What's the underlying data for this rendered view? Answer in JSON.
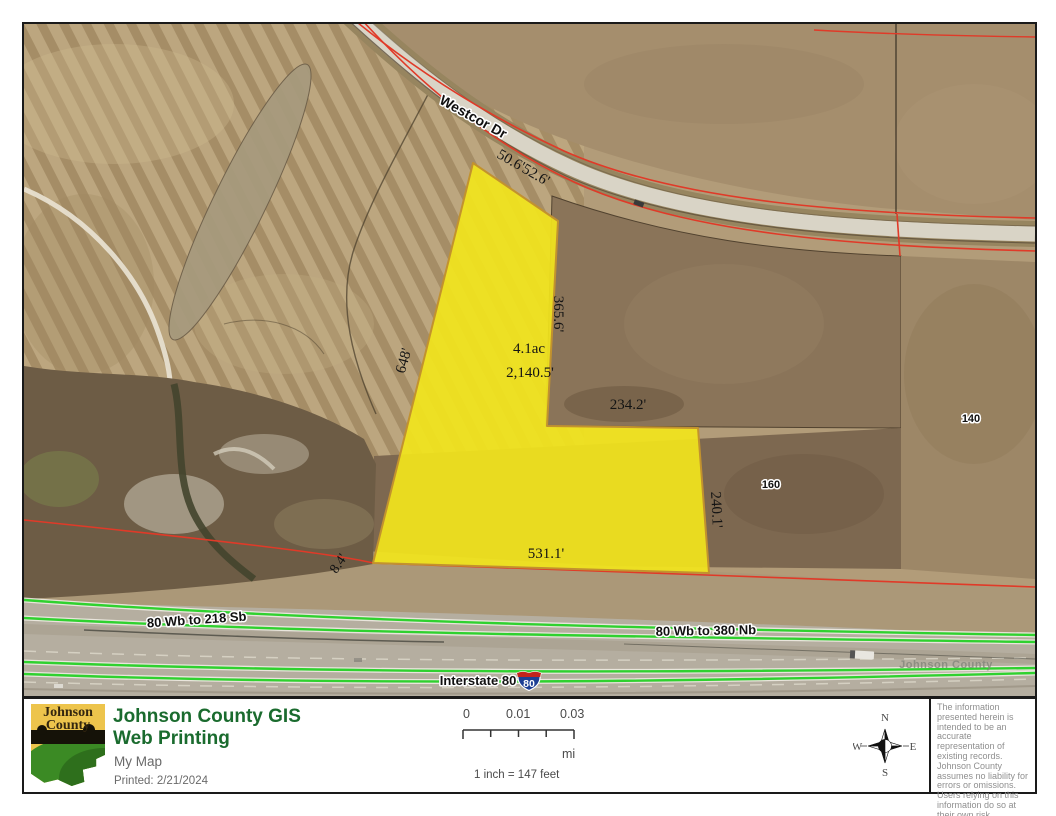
{
  "map": {
    "road_label": "Westcor Dr",
    "measurements": {
      "road_a": "50.6'",
      "road_b": "52.6'",
      "east_upper": "365.6'",
      "area": "4.1ac",
      "perimeter": "2,140.5'",
      "north_inner": "234.2'",
      "west": "648'",
      "east_lower": "240.1'",
      "south": "531.1'",
      "west_gap": "8.4'"
    },
    "badges": {
      "lot_160": "160",
      "lot_140": "140"
    },
    "highway": {
      "ramp_sb": "80 Wb to 218 Sb",
      "ramp_nb": "80 Wb to 380 Nb",
      "interstate": "Interstate 80",
      "shield": "80"
    },
    "watermark": "Johnson County",
    "colors": {
      "parcel_highlight": "#f1e41d",
      "parcel_boundary_red": "#e03a28",
      "road_centerline_green": "#2fd12f",
      "shield_blue": "#1d3f94",
      "shield_red": "#c2241c"
    }
  },
  "footer": {
    "logo": {
      "line1": "Johnson",
      "line2": "County"
    },
    "title_line1": "Johnson County GIS",
    "title_line2": "Web Printing",
    "map_name": "My Map",
    "printed": "Printed: 2/21/2024",
    "scale": {
      "tick0": "0",
      "tick1": "0.01",
      "tick2": "0.03",
      "unit": "mi",
      "equiv": "1 inch = 147 feet"
    },
    "compass": {
      "n": "N",
      "e": "E",
      "s": "S",
      "w": "W"
    },
    "disclaimer": "The information presented herein is intended to be an accurate representation of existing records.  Johnson County assumes no liability for errors or omissions. Users relying on this information do so at their own risk."
  }
}
